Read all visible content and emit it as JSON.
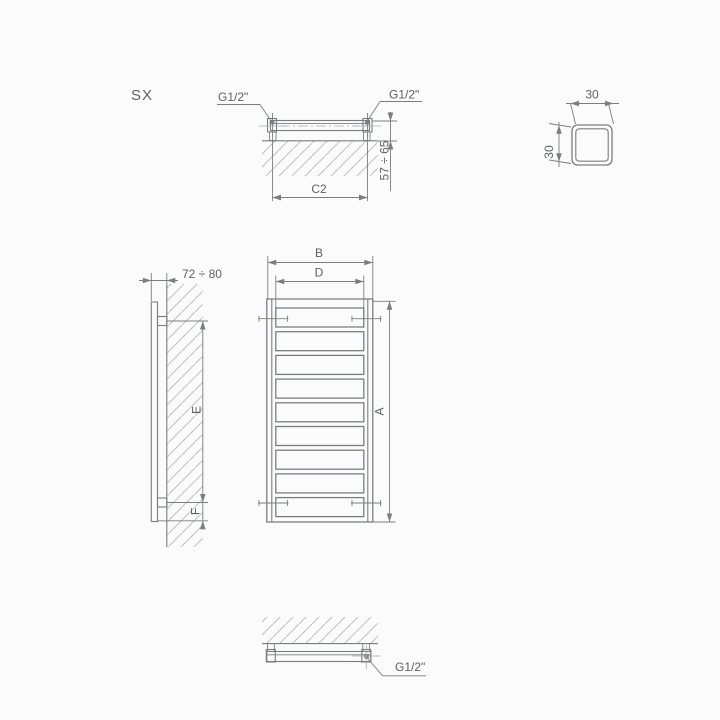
{
  "drawing": {
    "variant_label": "SX",
    "views": {
      "top": {
        "labels": {
          "left_connection": "G1/2\"",
          "right_connection": "G1/2\"",
          "connection_spacing": "C2",
          "mount_depth": "57 ÷ 65"
        }
      },
      "tube_profile": {
        "labels": {
          "width": "30",
          "height": "30"
        }
      },
      "side": {
        "labels": {
          "wall_clearance": "72 ÷ 80",
          "bracket_spacing": "E",
          "bracket_bottom_offset": "F"
        }
      },
      "front": {
        "rung_count": 9,
        "labels": {
          "overall_width": "B",
          "connection_spacing": "D",
          "overall_height": "A"
        }
      },
      "bottom": {
        "labels": {
          "connection": "G1/2\""
        }
      }
    },
    "colors": {
      "line": "#7b7e81",
      "text": "#5d5f62",
      "hatch": "#bdc0c3",
      "background": "#fbfbfb"
    }
  }
}
